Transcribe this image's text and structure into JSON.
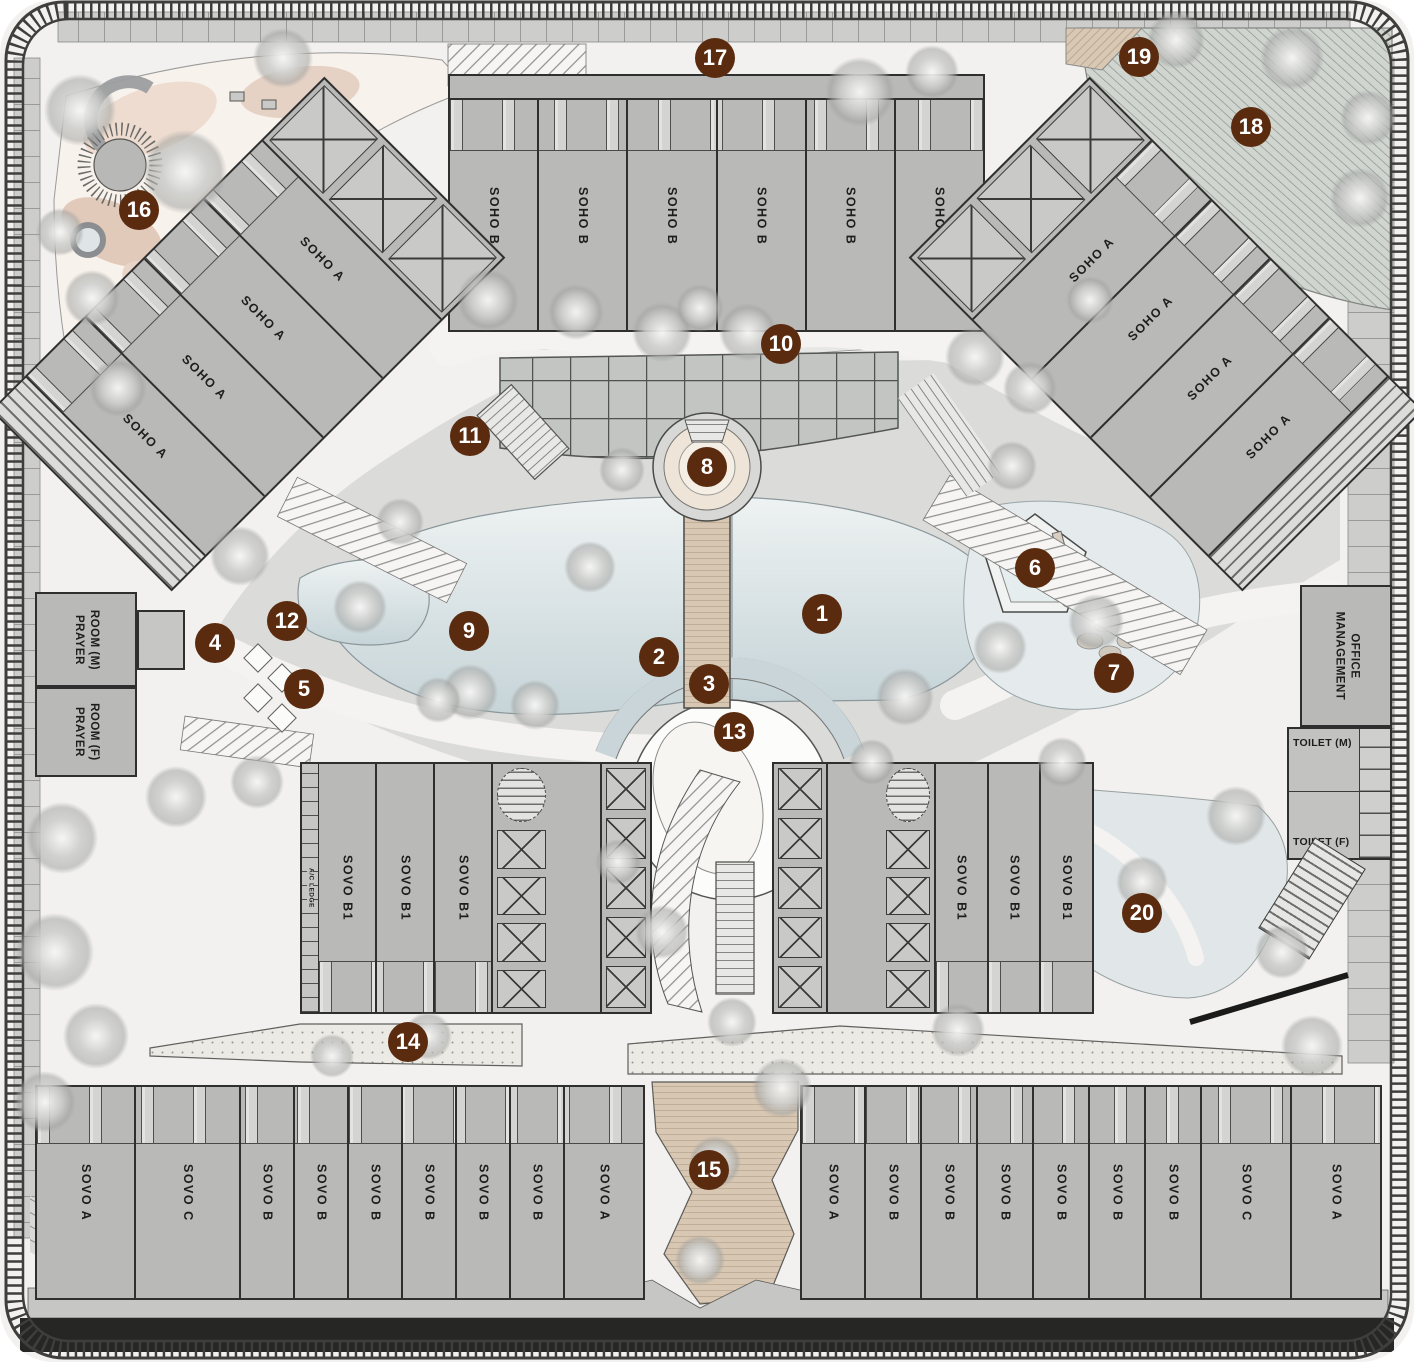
{
  "markers": [
    "1",
    "2",
    "3",
    "4",
    "5",
    "6",
    "7",
    "8",
    "9",
    "10",
    "11",
    "12",
    "13",
    "14",
    "15",
    "16",
    "17",
    "18",
    "19",
    "20"
  ],
  "labels": {
    "soho_b": [
      "SOHO B",
      "SOHO B",
      "SOHO B",
      "SOHO B",
      "SOHO B",
      "SOHO B"
    ],
    "soho_a_left": [
      "SOHO A",
      "SOHO A",
      "SOHO A",
      "SOHO A"
    ],
    "soho_a_right": [
      "SOHO A",
      "SOHO A",
      "SOHO A",
      "SOHO A"
    ],
    "sovo_b1_left": [
      "SOVO B1",
      "SOVO B1",
      "SOVO B1"
    ],
    "sovo_b1_right": [
      "SOVO B1",
      "SOVO B1",
      "SOVO B1"
    ],
    "sovo_row_left": [
      "SOVO A",
      "SOVO C",
      "SOVO B",
      "SOVO B",
      "SOVO B",
      "SOVO B",
      "SOVO B",
      "SOVO B",
      "SOVO A"
    ],
    "sovo_row_right": [
      "SOVO A",
      "SOVO B",
      "SOVO B",
      "SOVO B",
      "SOVO B",
      "SOVO B",
      "SOVO B",
      "SOVO C",
      "SOVO A"
    ]
  },
  "rooms": {
    "prayer_room_m": {
      "line1": "PRAYER",
      "line2": "ROOM (M)"
    },
    "prayer_room_f": {
      "line1": "PRAYER",
      "line2": "ROOM (F)"
    },
    "management_office": {
      "line1": "MANAGEMENT",
      "line2": "OFFICE"
    },
    "toilet_m": "TOILET (M)",
    "toilet_f": "TOILET (F)",
    "ac_ledge": "A/C LEDGE"
  },
  "colors": {
    "marker_bg": "#5a2b0f",
    "marker_text": "#ffffff",
    "building_fill": "#b9bab7",
    "building_outline": "#2f2f2f",
    "pool_light": "#ecf1f1",
    "pool_dark": "#c6d4d8",
    "walkway_tan": "#d8c7b2",
    "landscape_pink": "#ecdacd",
    "garden_gray_green": "#d0d5d0",
    "site_bg": "#f2f1ef",
    "boundary": "#3e3e3c"
  }
}
